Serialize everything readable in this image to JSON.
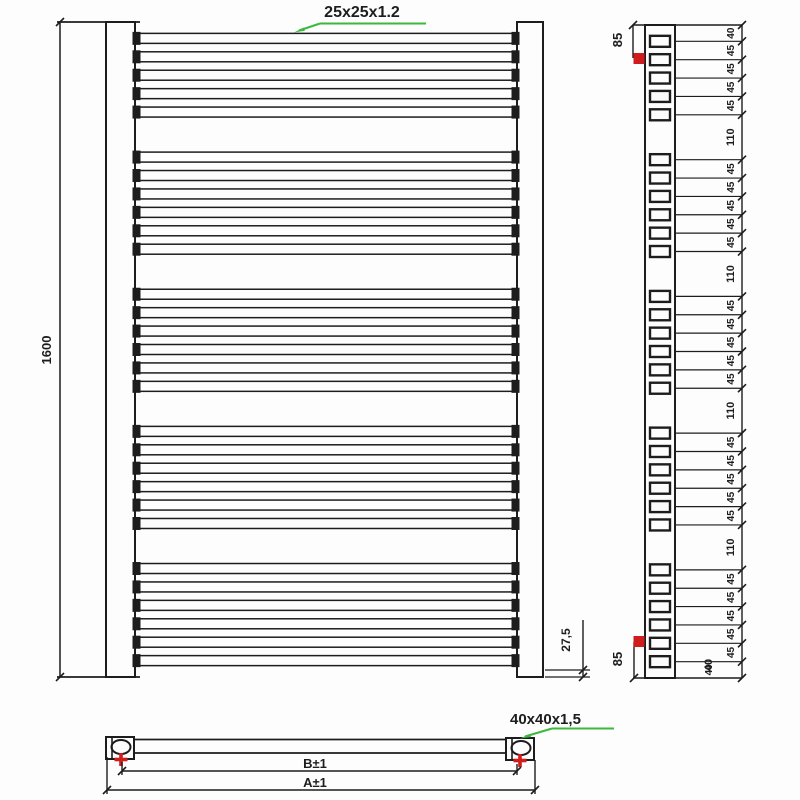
{
  "front_view": {
    "tube_size_label": "25x25x1.2",
    "height_label": "1600",
    "bottom_offset_label": "27,5"
  },
  "side_view": {
    "top_connection_offset_label": "85",
    "bottom_connection_offset_label": "85",
    "bottom_end_gap_label": "40",
    "segment_labels": [
      "40",
      "45",
      "45",
      "45",
      "45",
      "110",
      "45",
      "45",
      "45",
      "45",
      "45",
      "110",
      "45",
      "45",
      "45",
      "45",
      "45",
      "110",
      "45",
      "45",
      "45",
      "45",
      "45",
      "110",
      "45",
      "45",
      "45",
      "45",
      "45",
      "40"
    ]
  },
  "top_view": {
    "bracket_size_label": "40x40x1,5",
    "inner_width_label": "B±1",
    "outer_width_label": "A±1"
  },
  "structure": {
    "total_height_mm": 1600,
    "bar_groups": [
      5,
      6,
      6,
      6,
      6
    ],
    "top_offset_mm": 40,
    "bar_pitch_mm": 45,
    "group_gap_mm": 110,
    "bottom_offset_mm": 40
  },
  "colors": {
    "line": "#1d1d1d",
    "accent_green": "#3cb93c",
    "accent_red": "#cf1d1d"
  }
}
